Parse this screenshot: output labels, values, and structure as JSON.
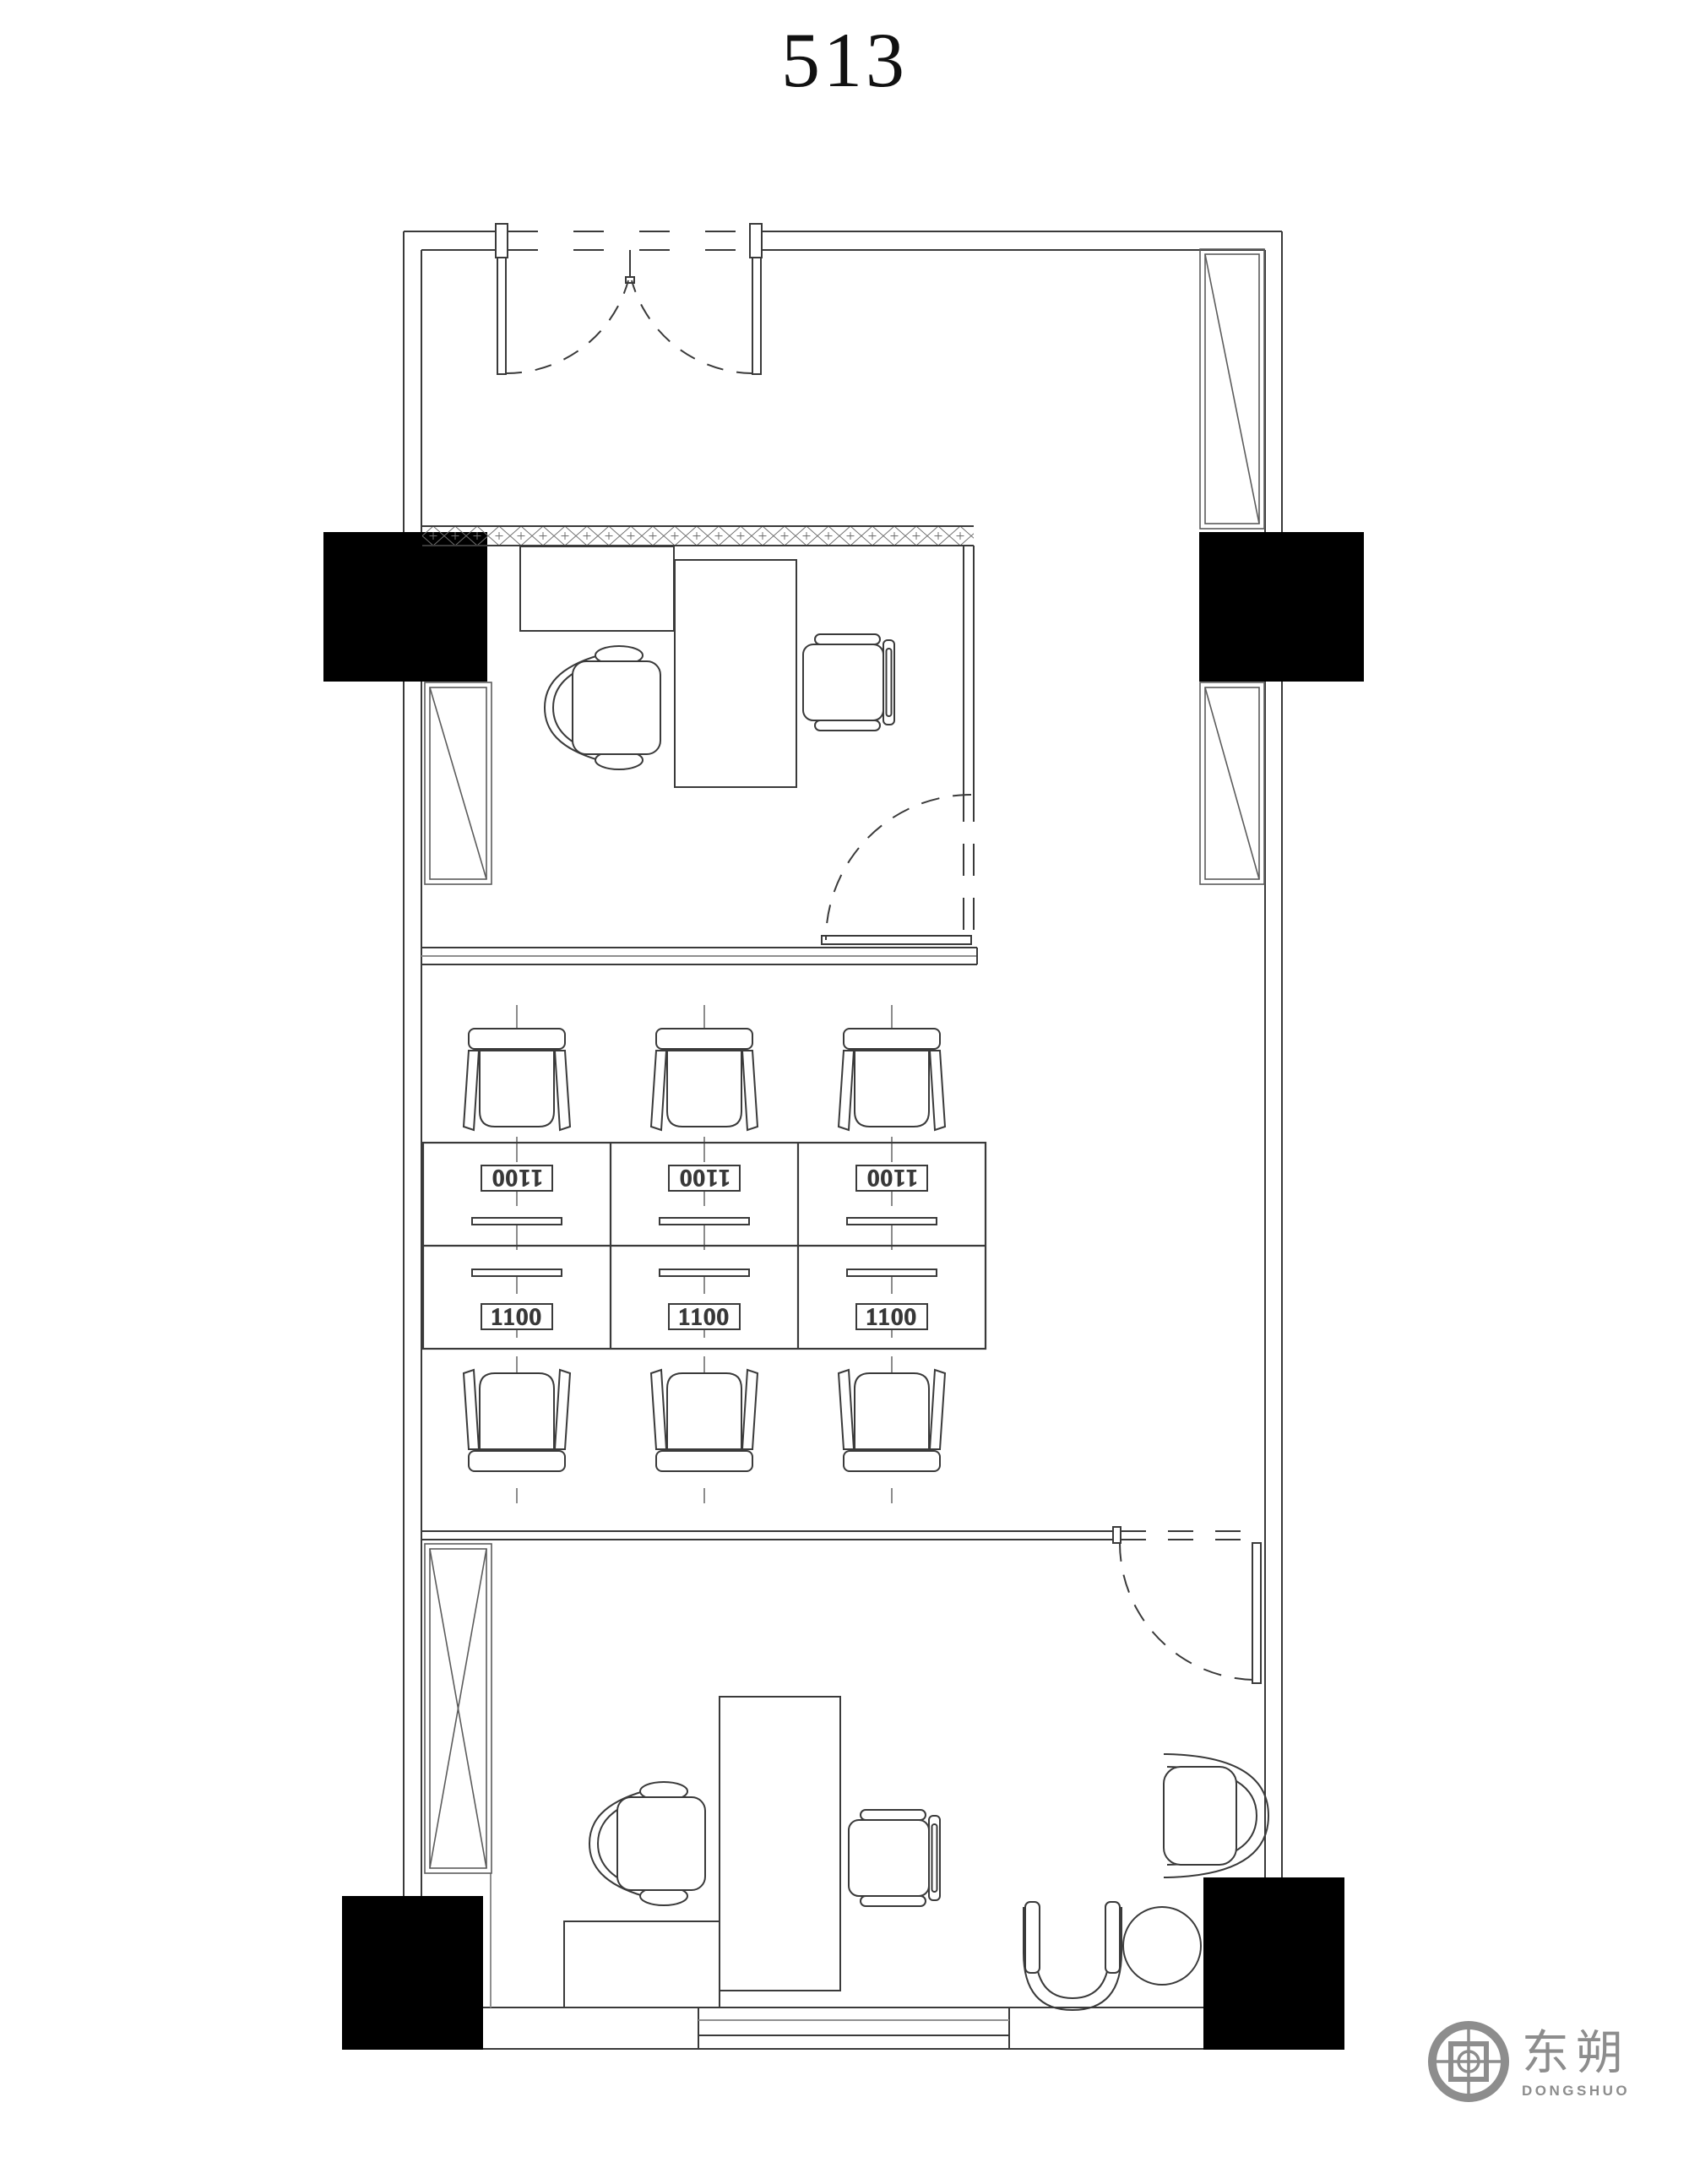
{
  "page": {
    "title": "513"
  },
  "plan": {
    "unit_label": "513",
    "colors": {
      "line": "#3a3a3a",
      "light_line": "#8f8f8f",
      "hatch": "#6f6f6f",
      "column_fill": "#000000",
      "background": "#ffffff"
    },
    "workstations": {
      "rows": 2,
      "columns": 3,
      "desks": [
        {
          "label": "1100",
          "orientation": "inverted"
        },
        {
          "label": "1100",
          "orientation": "inverted"
        },
        {
          "label": "1100",
          "orientation": "inverted"
        },
        {
          "label": "1100",
          "orientation": "normal"
        },
        {
          "label": "1100",
          "orientation": "normal"
        },
        {
          "label": "1100",
          "orientation": "normal"
        }
      ]
    }
  },
  "logo": {
    "icon": "crosshair-target-icon",
    "name_cn": "东朔",
    "name_en": "DONGSHUO",
    "color": "#8d8d8d"
  }
}
